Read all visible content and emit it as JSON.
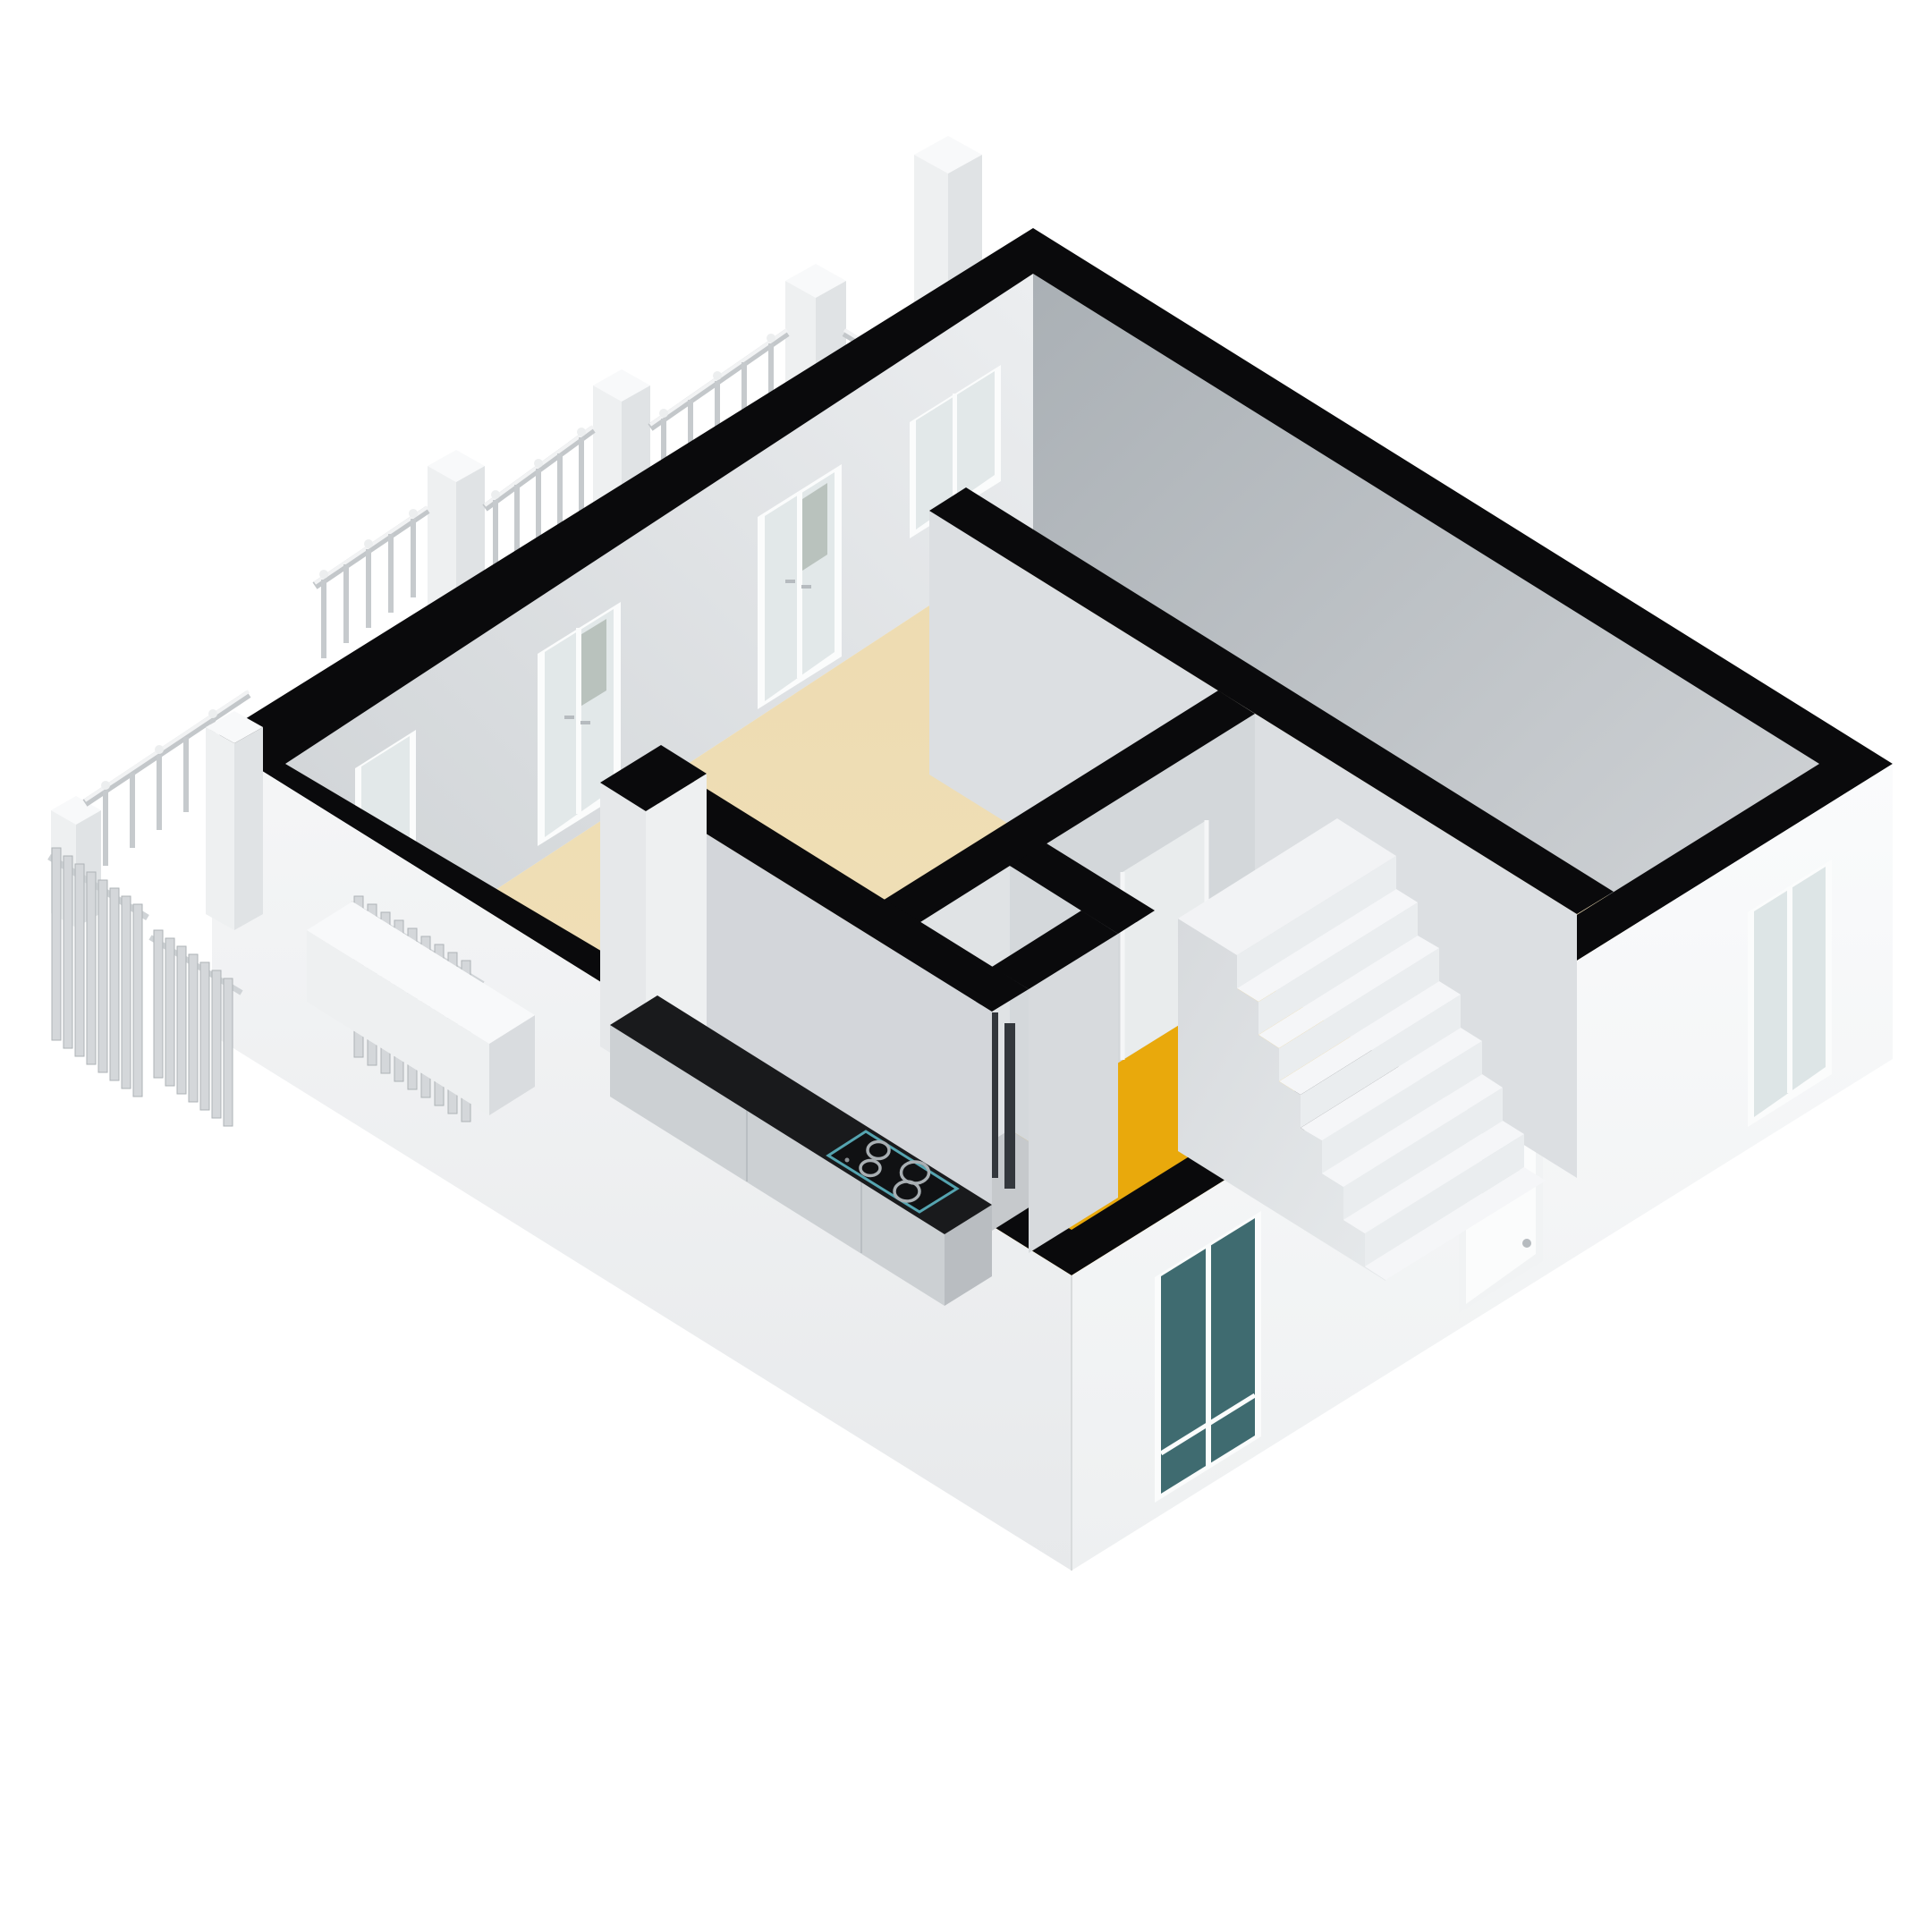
{
  "scene": {
    "type": "isometric-3d-floorplan-cutaway",
    "projection": "axonometric-top-oblique",
    "background": "#ffffff",
    "storeys_shown": 1
  },
  "palette": {
    "background": "#ffffff",
    "wall_cut": "#0a0a0c",
    "floor_main": "#f0dfb6",
    "floor_hall": "#e9a90c",
    "facade_light": "#f7f8f9",
    "facade_bright": "#fafbfc",
    "interior_wall_light": "#e4e7e9",
    "interior_wall_dark": "#b6bbc0",
    "partition_face": "#dcdfe2",
    "partition_face_mid": "#d3d7da",
    "closet_floor": "#c6c9cc",
    "stair_tread": "#f5f6f8",
    "stair_riser": "#eaedef",
    "stair_stringer": "#dfe2e5",
    "stair_landing": "#f2f3f5",
    "counter_top": "#191a1c",
    "cabinet_front": "#ccd0d3",
    "cabinet_end": "#b9bdc1",
    "cooktop_body": "#101113",
    "cooktop_rim": "#55a4b0",
    "burner_ring": "#a9afb3",
    "pipe_dark": "#33373c",
    "pipe_copper": "#b3663f",
    "glass_teal": "#3f6b70",
    "glass_light": "#dde5e6",
    "glass_door_pane": "#e2e8e9",
    "frame_white": "#fbfcfc",
    "island_top": "#f8f9fa",
    "railing_gray": "#c9cdd1",
    "radiator_slat": "#d4d7da",
    "pillar_face": "#eef0f1"
  },
  "rooms": [
    {
      "id": "living-kitchen",
      "floor": "beige",
      "floor_color_key": "floor_main"
    },
    {
      "id": "hallway-stairwell",
      "floor": "yellow",
      "floor_color_key": "floor_hall"
    },
    {
      "id": "back-room",
      "floor": "beige",
      "floor_color_key": "floor_main"
    },
    {
      "id": "meter-closet",
      "floor": "gray",
      "floor_color_key": "closet_floor"
    }
  ],
  "inventory": {
    "french_door_units_back_wall": 3,
    "interior_corner_window_units": 1,
    "facade_windows": 2,
    "entrance_doors": 1,
    "interior_doorways": 1,
    "stair_treads": 7,
    "stair_landings": 1,
    "cooktop_burners": 4,
    "meter_pipes_dark": 3,
    "meter_pipes_copper": 2,
    "radiator_panels": 3,
    "balcony_pillars": 6,
    "railing_segments": 5,
    "kitchen_counters": 2
  }
}
